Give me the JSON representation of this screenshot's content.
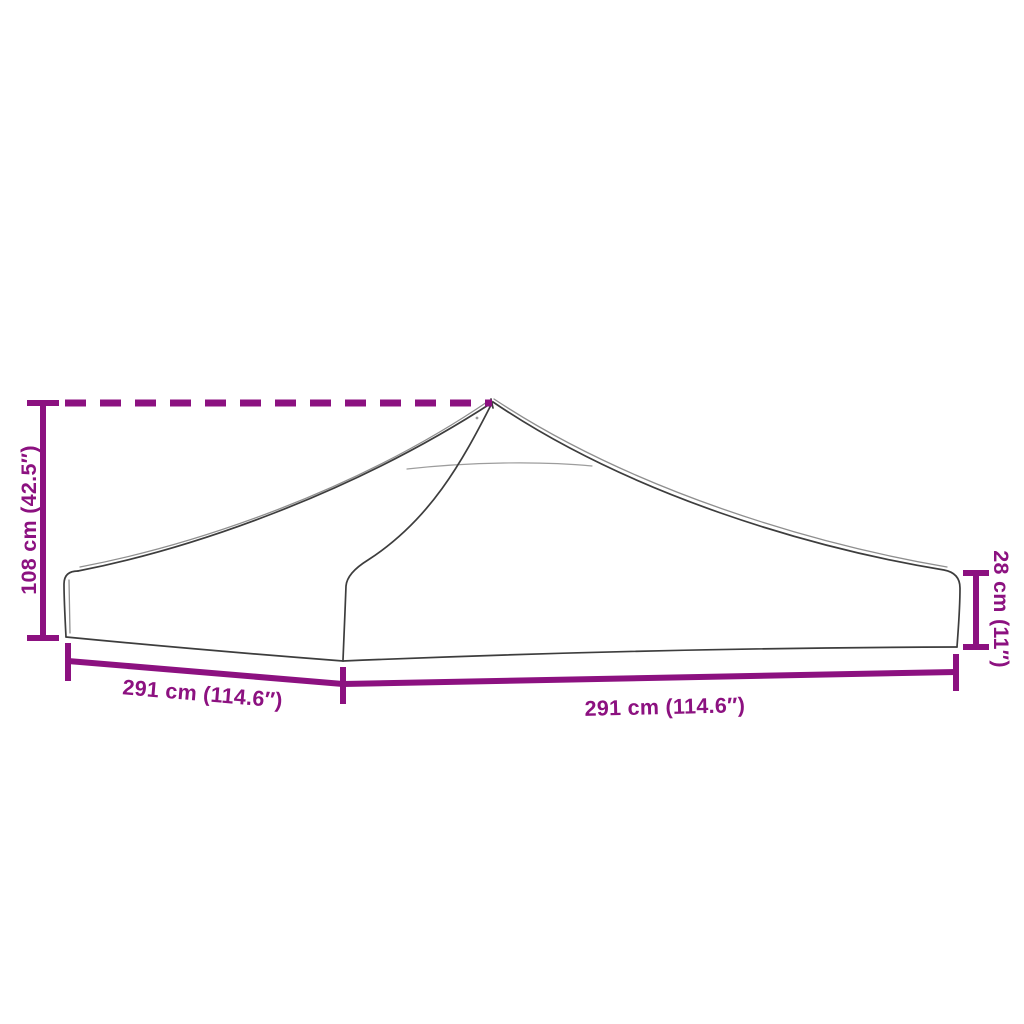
{
  "page": {
    "background": "#ffffff"
  },
  "diagram": {
    "kind": "product-dimension-line-drawing",
    "accent_color": "#8c1180",
    "outline_color": "#3d3d3d",
    "dimensions": {
      "peak_height": {
        "label": "108 cm (42.5″)"
      },
      "valance_height": {
        "label": "28 cm (11″)"
      },
      "left_edge_width": {
        "label": "291 cm (114.6″)"
      },
      "right_edge_width": {
        "label": "291 cm (114.6″)"
      }
    }
  }
}
